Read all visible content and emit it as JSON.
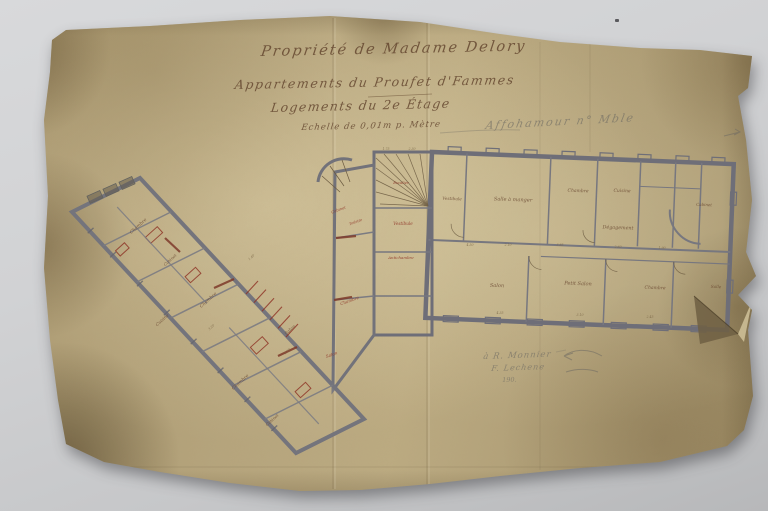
{
  "scene": {
    "table_color_top": "#d8d9db",
    "table_color_bottom": "#b7b8ba",
    "paper_base": "#b2a17a",
    "paper_light": "#c6b68d",
    "paper_dark_edge": "#8a7a57",
    "stain_dark": "#5f4e30"
  },
  "title_block": {
    "line1": "Propriété de Madame Delory",
    "line2": "Appartements du Proufet d'Fammes",
    "line3": "Logements du 2e Étage",
    "line4": "Echelle de 0,01m p. Mètre",
    "ink_color": "#6f4f38"
  },
  "annotations": {
    "pencil_top_right": "Affohamour n° Mble",
    "pencil_bottom_line1": "à R. Monnier",
    "pencil_bottom_line2": "F. Lechene",
    "pencil_bottom_line3": "190.",
    "pencil_color": "#8b887f"
  },
  "plan": {
    "colors": {
      "ink": "#6b4a33",
      "red": "#8d3023",
      "dim": "#7c6848",
      "wall": "#70707a",
      "pencil": "#8f8c84"
    },
    "labels": [
      {
        "t": "Vestibule",
        "x": 452,
        "y": 200,
        "s": 4.2,
        "c": "ink",
        "r": 2
      },
      {
        "t": "Salle à manger",
        "x": 513,
        "y": 201,
        "s": 5,
        "c": "ink",
        "r": 2
      },
      {
        "t": "Chambre",
        "x": 578,
        "y": 192,
        "s": 4.5,
        "c": "ink",
        "r": 2
      },
      {
        "t": "Cuisine",
        "x": 622,
        "y": 192,
        "s": 4.5,
        "c": "ink",
        "r": 2
      },
      {
        "t": "Cabinet",
        "x": 704,
        "y": 206,
        "s": 4,
        "c": "ink",
        "r": 2
      },
      {
        "t": "Dégagement",
        "x": 618,
        "y": 229,
        "s": 4.8,
        "c": "ink",
        "r": 2
      },
      {
        "t": "Salon",
        "x": 497,
        "y": 287,
        "s": 5,
        "c": "ink",
        "r": 2
      },
      {
        "t": "Petit Salon",
        "x": 578,
        "y": 285,
        "s": 5,
        "c": "ink",
        "r": 2
      },
      {
        "t": "Chambre",
        "x": 655,
        "y": 289,
        "s": 4.5,
        "c": "ink",
        "r": 2
      },
      {
        "t": "Salle",
        "x": 716,
        "y": 288,
        "s": 4.2,
        "c": "ink",
        "r": 2
      },
      {
        "t": "Escalier",
        "x": 401,
        "y": 184,
        "s": 3.8,
        "c": "red",
        "r": 0
      },
      {
        "t": "Vestibule",
        "x": 403,
        "y": 225,
        "s": 4.2,
        "c": "red",
        "r": 0
      },
      {
        "t": "Antichambre",
        "x": 401,
        "y": 259,
        "s": 3.9,
        "c": "red",
        "r": 0
      },
      {
        "t": "Cabinet",
        "x": 339,
        "y": 211,
        "s": 3.8,
        "c": "red",
        "r": -20
      },
      {
        "t": "Toilette",
        "x": 356,
        "y": 223,
        "s": 3.6,
        "c": "red",
        "r": -20
      },
      {
        "t": "Chambre",
        "x": 350,
        "y": 302,
        "s": 4.2,
        "c": "red",
        "r": -20
      },
      {
        "t": "Salon",
        "x": 332,
        "y": 356,
        "s": 4.2,
        "c": "red",
        "r": -20
      },
      {
        "t": "Chambre",
        "x": 139,
        "y": 227,
        "s": 4.5,
        "c": "ink",
        "r": -42
      },
      {
        "t": "Cabinet",
        "x": 171,
        "y": 261,
        "s": 4,
        "c": "ink",
        "r": -42
      },
      {
        "t": "Chambre",
        "x": 209,
        "y": 301,
        "s": 4.5,
        "c": "ink",
        "r": -42
      },
      {
        "t": "Cuisine",
        "x": 163,
        "y": 321,
        "s": 4.2,
        "c": "ink",
        "r": -42
      },
      {
        "t": "Chambre",
        "x": 241,
        "y": 383,
        "s": 4.5,
        "c": "ink",
        "r": -42
      },
      {
        "t": "Cabinet",
        "x": 273,
        "y": 421,
        "s": 4,
        "c": "ink",
        "r": -42
      },
      {
        "t": "Salon",
        "x": 291,
        "y": 331,
        "s": 4.5,
        "c": "ink",
        "r": -42
      },
      {
        "t": "4.50",
        "x": 470,
        "y": 246,
        "s": 3.2,
        "c": "dim",
        "r": 0
      },
      {
        "t": "2.10",
        "x": 508,
        "y": 246,
        "s": 3.2,
        "c": "dim",
        "r": 0
      },
      {
        "t": "3.85",
        "x": 560,
        "y": 246,
        "s": 3.2,
        "c": "dim",
        "r": 0
      },
      {
        "t": "2.60",
        "x": 618,
        "y": 248,
        "s": 3.2,
        "c": "dim",
        "r": 0
      },
      {
        "t": "1.90",
        "x": 662,
        "y": 249,
        "s": 3.2,
        "c": "dim",
        "r": 0
      },
      {
        "t": "4.35",
        "x": 500,
        "y": 314,
        "s": 3.2,
        "c": "dim",
        "r": 0
      },
      {
        "t": "3.10",
        "x": 580,
        "y": 316,
        "s": 3.2,
        "c": "dim",
        "r": 0
      },
      {
        "t": "2.45",
        "x": 650,
        "y": 318,
        "s": 3.2,
        "c": "dim",
        "r": 0
      },
      {
        "t": "2.50",
        "x": 288,
        "y": 352,
        "s": 3.2,
        "c": "dim",
        "r": -42
      },
      {
        "t": "3.20",
        "x": 212,
        "y": 328,
        "s": 3.2,
        "c": "dim",
        "r": -42
      },
      {
        "t": "1.40",
        "x": 252,
        "y": 258,
        "s": 3.2,
        "c": "dim",
        "r": -42
      },
      {
        "t": "1.75",
        "x": 386,
        "y": 150,
        "s": 3.2,
        "c": "dim",
        "r": 0
      },
      {
        "t": "2.30",
        "x": 412,
        "y": 150,
        "s": 3.2,
        "c": "dim",
        "r": 0
      }
    ]
  }
}
